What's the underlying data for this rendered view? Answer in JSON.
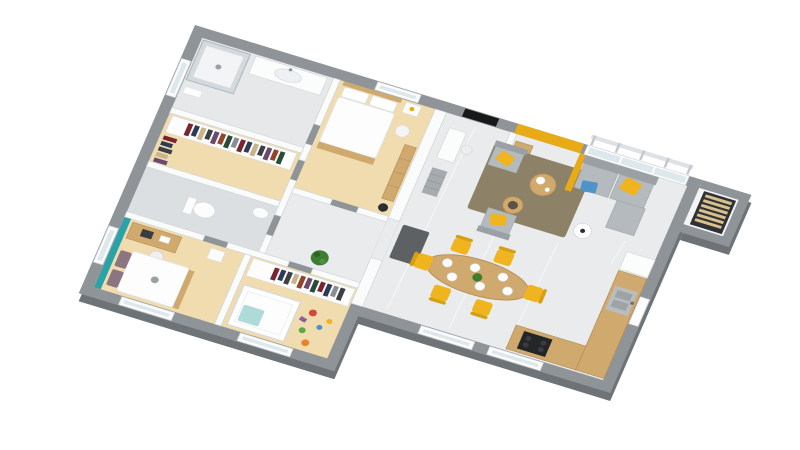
{
  "meta": {
    "description": "Isometric 3D rendering of a single-storey house floor plan on a white background, no text labels",
    "view": "axonometric top-down, rotated clockwise ~20 degrees",
    "background": "#ffffff"
  },
  "colors": {
    "exterior_wall": "#8f9499",
    "exterior_wall_shadow": "#6e7377",
    "interior_wall": "#fafbfb",
    "interior_wall_stroke": "#d3d6d9",
    "floor_wood": "#f0dcae",
    "floor_tile": "#e9ebed",
    "floor_tile_dark": "#dcdfe2",
    "accent_yellow": "#e9ab15",
    "accent_teal": "#2ba2a8",
    "chair_yellow": "#f0b41e",
    "sofa_gray": "#9aa0a4",
    "sofa_cushion": "#b4babd",
    "rug_olive": "#8d8268",
    "wood": "#cfa96d",
    "wood_dark": "#b58f55",
    "door_black": "#17181a",
    "tv_black": "#1d1f21",
    "glass": "#dce8ec",
    "steel": "#b9bdc0",
    "plant_green": "#3f7d33",
    "cooktop_black": "#232527",
    "mat_gray": "#5d6164",
    "pillow_blue": "#4f93c8",
    "crib_teal": "#aedad8",
    "toy_red": "#d6453d",
    "toy_green": "#59a84b",
    "toy_orange": "#e8842c",
    "toy_purple": "#8a5fa0"
  },
  "rooms": [
    {
      "id": "bathroom",
      "floor": "tile",
      "furniture": [
        "glass shower",
        "vanity with basin"
      ]
    },
    {
      "id": "walk-in-closet",
      "floor": "wood",
      "furniture": [
        "hanging clothes racks"
      ]
    },
    {
      "id": "master-bedroom",
      "floor": "wood",
      "furniture": [
        "double bed",
        "nightstand",
        "pouf",
        "ladder shelf",
        "black stool"
      ]
    },
    {
      "id": "wc",
      "floor": "tile",
      "furniture": [
        "toilet",
        "small basin"
      ]
    },
    {
      "id": "hallway",
      "floor": "tile",
      "furniture": [
        "green plant",
        "doormat"
      ]
    },
    {
      "id": "bedroom-2",
      "floor": "wood",
      "furniture": [
        "teal accent wall",
        "desk with laptop",
        "chair",
        "double bed",
        "nightstand"
      ]
    },
    {
      "id": "nursery",
      "floor": "wood",
      "furniture": [
        "wardrobe with clothes",
        "crib",
        "scattered toys"
      ]
    },
    {
      "id": "living-dining",
      "floor": "tile",
      "furniture": [
        "black front door",
        "yellow accent wall",
        "glass bay with railing",
        "TV sideboard",
        "floor lamp",
        "entry desk and stool",
        "ladder shelf",
        "gray sofa with yellow and blue pillows",
        "two gray armchairs",
        "olive rug",
        "two round coffee tables",
        "white side table",
        "oval dining table",
        "6 yellow chairs",
        "plates and centerpiece"
      ]
    },
    {
      "id": "kitchen",
      "floor": "tile",
      "furniture": [
        "L-shaped wood counter",
        "steel sink",
        "black cooktop",
        "fridge unit"
      ]
    },
    {
      "id": "pantry",
      "floor": "tile",
      "furniture": [
        "slatted storage shelf"
      ]
    }
  ]
}
